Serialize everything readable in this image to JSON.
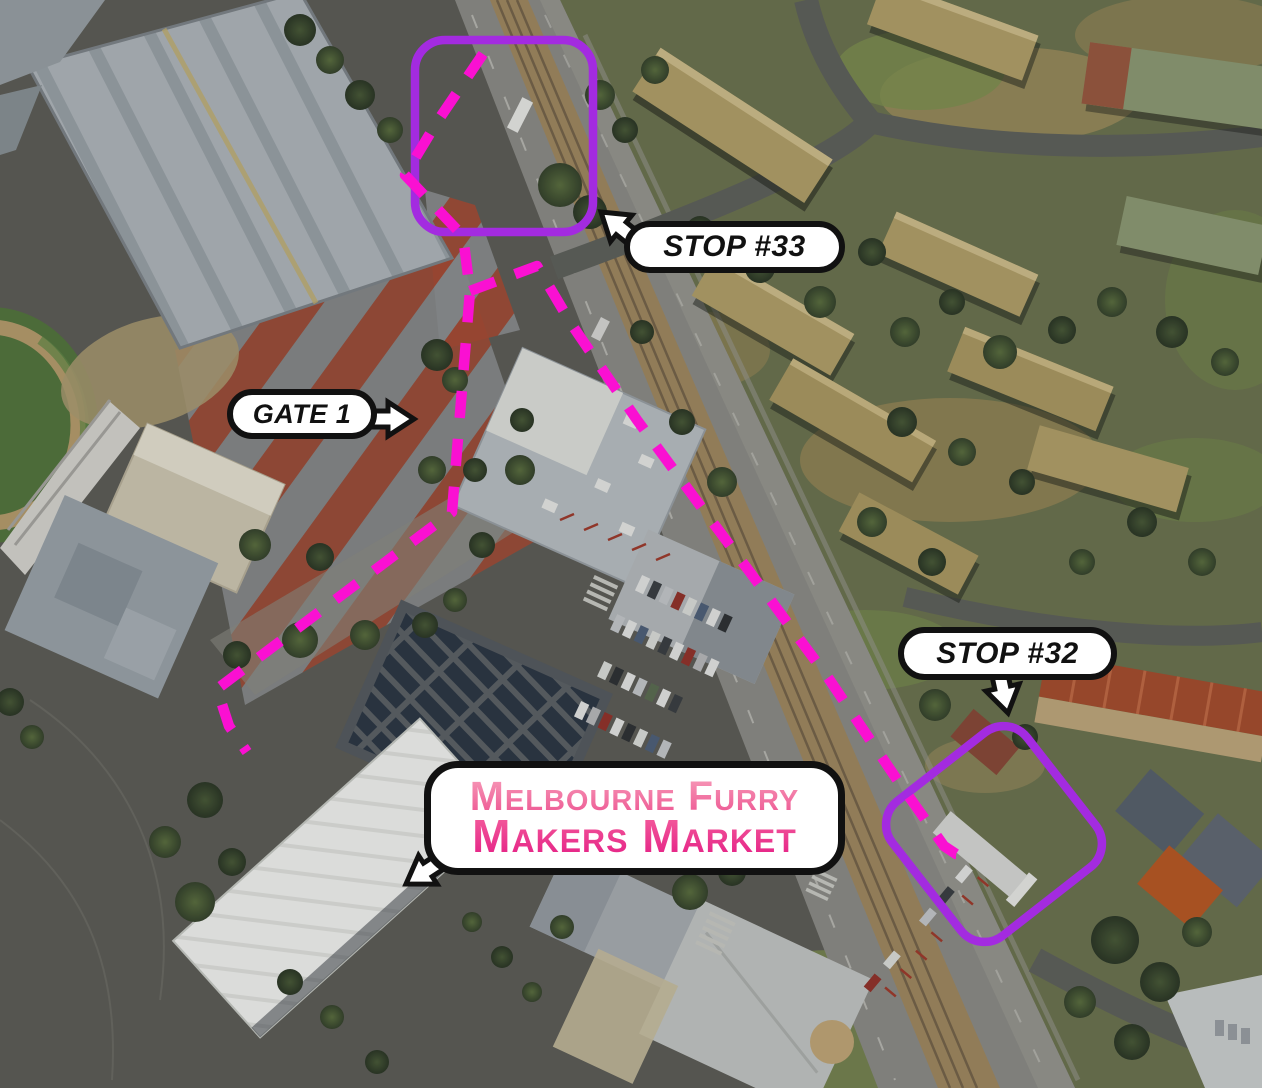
{
  "map": {
    "kind": "aerial-callout-map",
    "colors": {
      "route_path": "#fa10d2",
      "zone_outline": "#a32be0",
      "callout_fill": "#ffffff",
      "callout_border": "#111111",
      "callout_text": "#111111",
      "market_line1_gradient_top": "#f79ab8",
      "market_line1_gradient_bottom": "#ed5592",
      "market_line2_gradient_top": "#f45f9d",
      "market_line2_gradient_bottom": "#e41e85"
    },
    "callouts": {
      "stop33": {
        "label": "STOP #33",
        "arrow_direction": "up-left"
      },
      "gate1": {
        "label": "GATE 1",
        "arrow_direction": "right"
      },
      "stop32": {
        "label": "STOP #32",
        "arrow_direction": "down"
      },
      "market": {
        "label_line1": "Melbourne Furry",
        "label_line2": "Makers Market",
        "arrow_direction": "down-left"
      }
    },
    "zones": [
      {
        "name": "stop33-tram-stop-zone"
      },
      {
        "name": "stop32-tram-stop-zone"
      }
    ],
    "routes": [
      {
        "name": "route-stop33-to-market",
        "style": "dashed"
      },
      {
        "name": "route-along-road-to-stop32",
        "style": "dashed"
      }
    ]
  }
}
